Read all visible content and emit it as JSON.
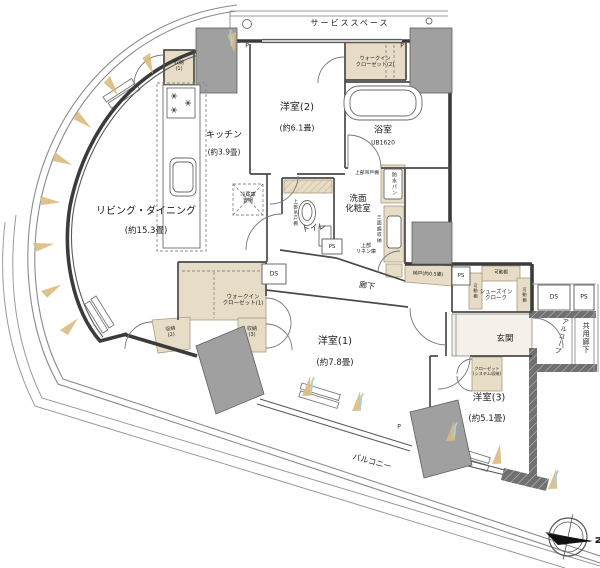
{
  "plan": {
    "rooms": {
      "living_dining": {
        "name": "リビング・ダイニング",
        "size": "(約15.3畳)"
      },
      "kitchen": {
        "name": "キッチン",
        "size": "(約3.9畳)"
      },
      "bedroom1": {
        "name": "洋室(1)",
        "size": "(約7.8畳)"
      },
      "bedroom2": {
        "name": "洋室(2)",
        "size": "(約6.1畳)"
      },
      "bedroom3": {
        "name": "洋室(3)",
        "size": "(約5.1畳)"
      },
      "bathroom": {
        "name": "浴室",
        "size": "UB1620"
      },
      "washroom": {
        "name_line1": "洗面",
        "name_line2": "化粧室"
      },
      "toilet": {
        "name": "トイレ"
      },
      "hallway": {
        "name": "廊下"
      },
      "entrance": {
        "name": "玄関"
      },
      "alcove": {
        "name": "アルコーブ"
      },
      "shared_corridor": {
        "name": "共用廊下"
      },
      "balcony": {
        "name": "バルコニー"
      },
      "service_space": {
        "name": "サービススペース"
      }
    },
    "storage": {
      "closet1": {
        "line1": "収納",
        "line2": "(1)"
      },
      "closet2": {
        "line1": "収納",
        "line2": "(2)"
      },
      "closet3": {
        "line1": "収納",
        "line2": "(3)"
      },
      "wic1": {
        "line1": "ウォークイン",
        "line2": "クローゼット(1)"
      },
      "wic2": {
        "line1": "ウォークイン",
        "line2": "クローゼット(2)"
      },
      "nando": {
        "name": "納戸(約0.5畳)"
      },
      "shoes_in_cloak": {
        "line1": "シューズイン",
        "line2": "クローク"
      },
      "system_closet": {
        "line1": "クローゼット",
        "line2": "(システム収納)"
      },
      "movable_shelf": {
        "name": "可動棚"
      }
    },
    "fixtures": {
      "refrigerator_space": {
        "line1": "冷蔵庫",
        "line2": "置場"
      },
      "waterproof_pan": {
        "name": "防水パン"
      },
      "upper_hanging_cabinet": {
        "name": "上部吊戸棚"
      },
      "mirror_cabinet": {
        "name": "三面鏡収納"
      },
      "upper_linen": {
        "line1": "上部",
        "line2": "リネン庫"
      }
    },
    "shafts": {
      "ds": "DS",
      "ps": "PS"
    },
    "marks": {
      "pipe": "P",
      "north": "N"
    }
  }
}
